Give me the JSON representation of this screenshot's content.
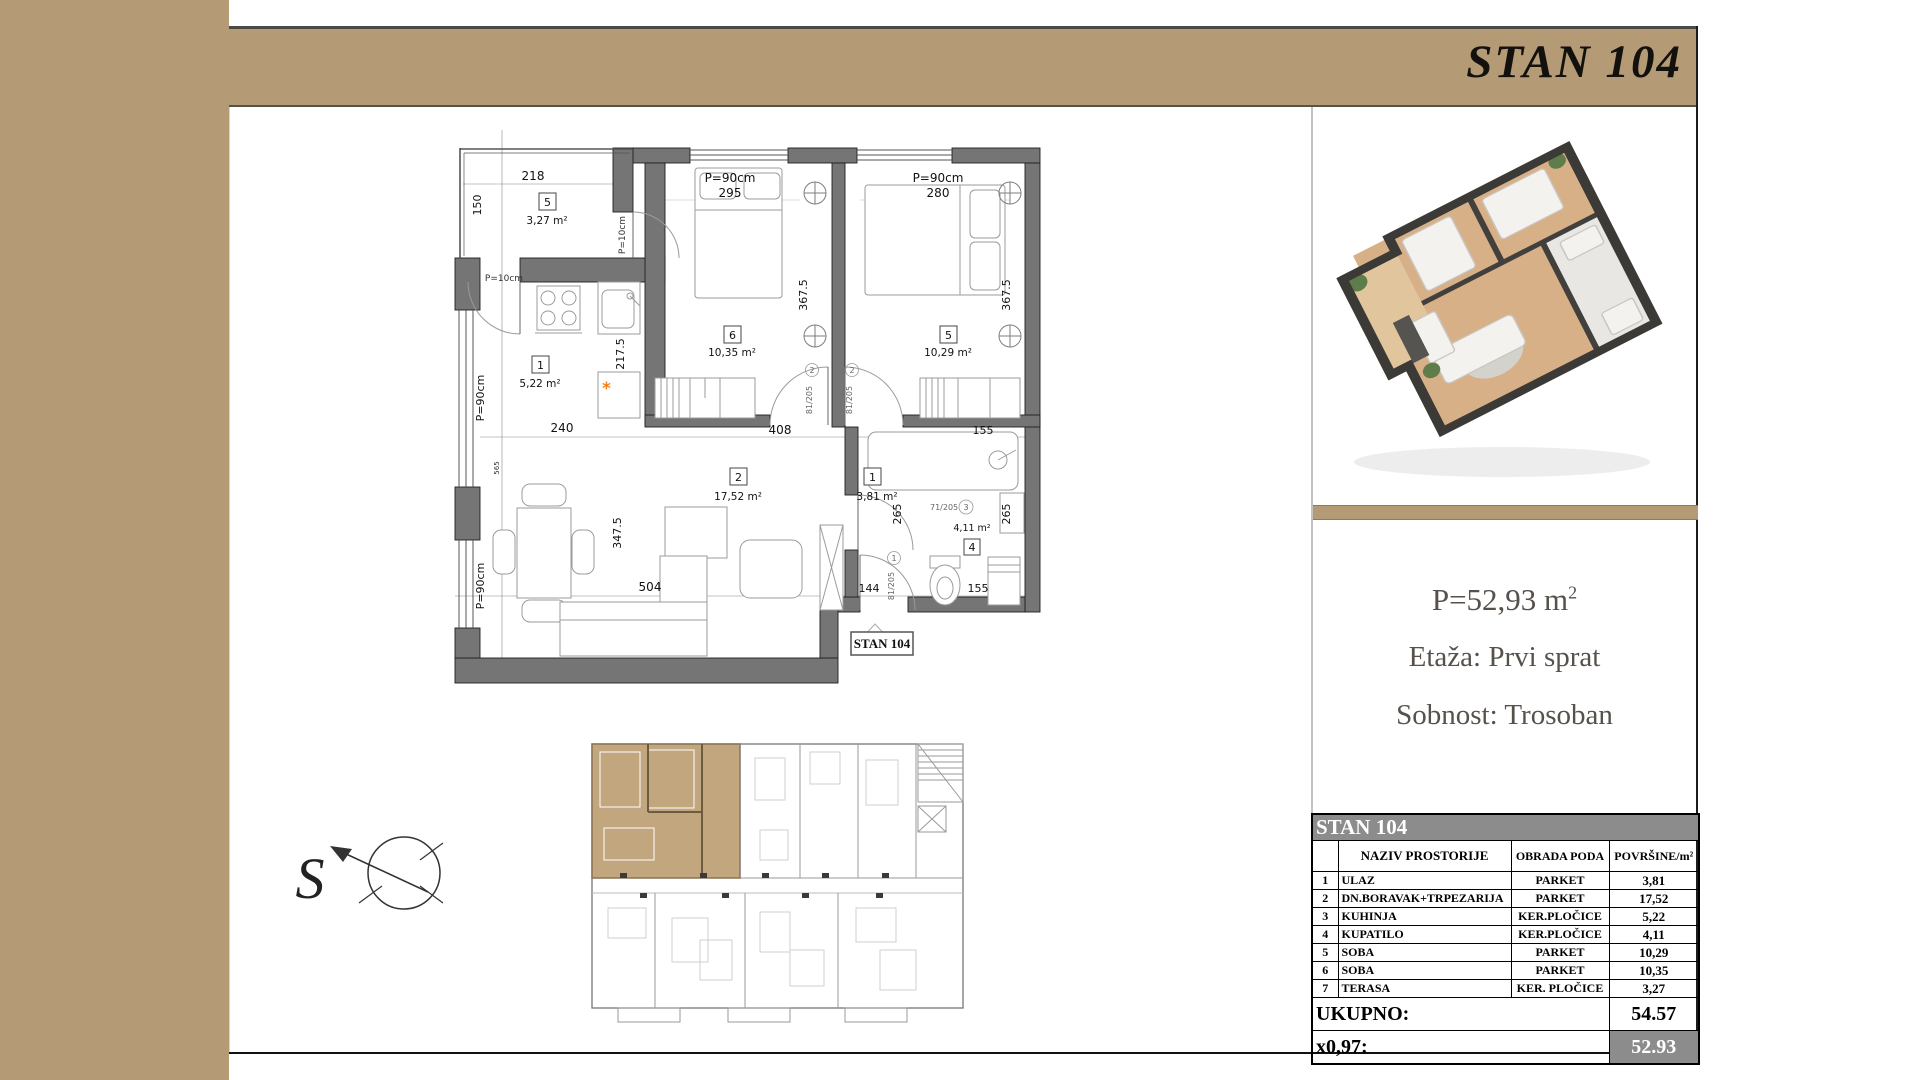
{
  "title": "STAN 104",
  "panel": {
    "area_label": "P=52,93 m",
    "area_sup": "2",
    "floor": "Etaža: Prvi sprat",
    "sobnost": "Sobnost: Trosoban"
  },
  "table": {
    "header": "STAN 104",
    "col_num": "",
    "col_naziv": "NAZIV PROSTORIJE",
    "col_obrada": "OBRADA PODA",
    "col_povrsine": "POVRŠINE/m²",
    "rows": [
      [
        "1",
        "ULAZ",
        "PARKET",
        "3,81"
      ],
      [
        "2",
        "DN.BORAVAK+TRPEZARIJA",
        "PARKET",
        "17,52"
      ],
      [
        "3",
        "KUHINJA",
        "KER.PLOČICE",
        "5,22"
      ],
      [
        "4",
        "KUPATILO",
        "KER.PLOČICE",
        "4,11"
      ],
      [
        "5",
        "SOBA",
        "PARKET",
        "10,29"
      ],
      [
        "6",
        "SOBA",
        "PARKET",
        "10,35"
      ],
      [
        "7",
        "TERASA",
        "KER. PLOČICE",
        "3,27"
      ]
    ],
    "total_label": "UKUPNO:",
    "total_value": "54.57",
    "factor_label": "x0,97:",
    "factor_value": "52.93"
  },
  "plan": {
    "stan_label": "STAN 104",
    "boiler": "*",
    "rooms": {
      "terasa": {
        "num": "5",
        "area": "3,27 m²"
      },
      "kuhinja": {
        "num": "1",
        "area": "5,22 m²"
      },
      "dnevni": {
        "num": "2",
        "area": "17,52 m²"
      },
      "ulaz": {
        "num": "1",
        "area": "3,81 m²"
      },
      "kupatilo": {
        "num": "4",
        "area": "4,11 m²"
      },
      "soba_a": {
        "num": "6",
        "area": "10,35 m²"
      },
      "soba_b": {
        "num": "5",
        "area": "10,29 m²"
      }
    },
    "dims": {
      "d218": "218",
      "d150": "150",
      "p90_t1": "P=90cm",
      "n295": "295",
      "p90_t2": "P=90cm",
      "n280": "280",
      "d367a": "367.5",
      "d367b": "367.5",
      "p10a": "P=10cm",
      "p10b": "P=10cm",
      "d2175": "217.5",
      "d240": "240",
      "p90_l1": "P=90cm",
      "p90_l2": "P=90cm",
      "d565": "565",
      "d3475": "347.5",
      "d408": "408",
      "d155top": "155",
      "d265a": "265",
      "d265b": "265",
      "d504": "504",
      "d144": "144",
      "d155bot": "155"
    },
    "doors": {
      "a": "81/205",
      "a_n": "2",
      "b": "81/205",
      "b_n": "2",
      "c": "81/205",
      "c_n": "1",
      "d": "71/205",
      "d_n": "3"
    }
  },
  "compass": {
    "letter": "S"
  },
  "colors": {
    "accent_tan": "#b49a75",
    "wall_gray": "#757575",
    "table_gray": "#8c8c8c",
    "boiler_orange": "#f07f1e"
  }
}
